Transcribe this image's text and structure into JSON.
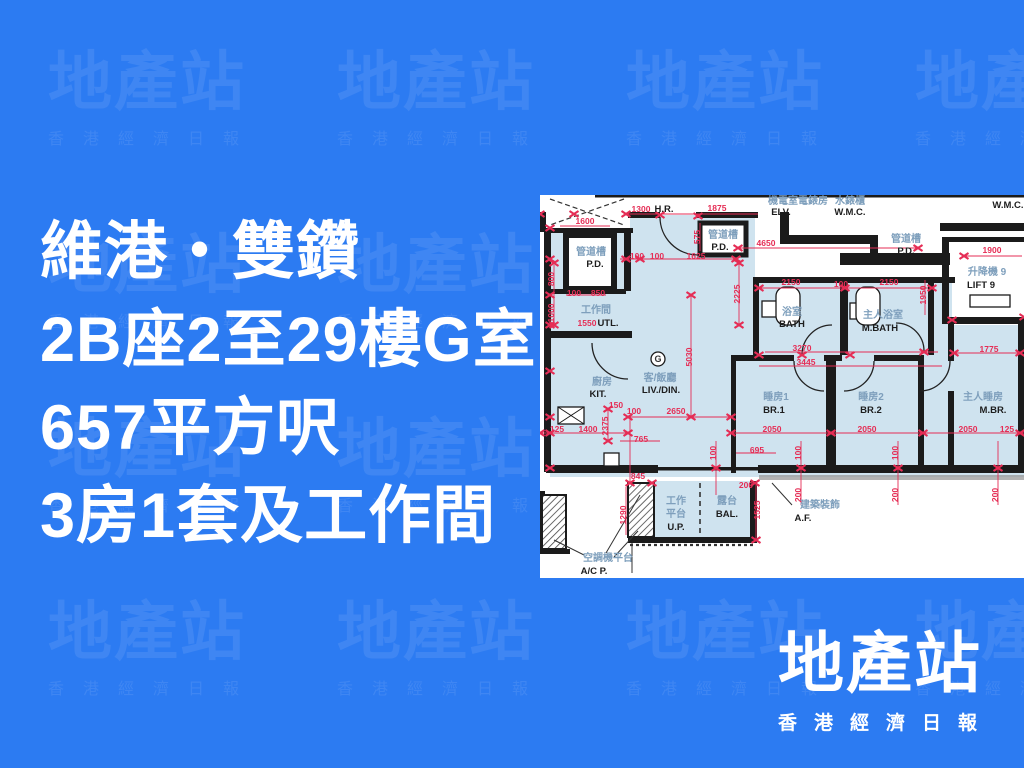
{
  "colors": {
    "background": "#2C7BF2",
    "watermark": "rgba(255,255,255,0.09)",
    "headline_text": "#FFFFFF",
    "plan_room_fill": "#CFE3EF",
    "plan_wall": "#1B1B1B",
    "plan_dimension": "#E52D55",
    "plan_label_chinese": "#7E9FBC",
    "plan_label_english": "#1D1D1D"
  },
  "watermark": {
    "title": "地產站",
    "subtitle": "香港經濟日報"
  },
  "headline": {
    "line1": "維港・雙鑽",
    "line2": "2B座2至29樓G室",
    "line3": "657平方呎",
    "line4": "3房1套及工作間"
  },
  "logo": {
    "title": "地產站",
    "subtitle": "香港經濟日報"
  },
  "floorplan": {
    "labels": [
      {
        "t": "H.R.",
        "x": 124,
        "y": 17,
        "c": "en"
      },
      {
        "t": "機電室電錶房",
        "x": 258,
        "y": 9,
        "c": "zh"
      },
      {
        "t": "ELV.",
        "x": 241,
        "y": 20,
        "c": "en"
      },
      {
        "t": "水錶櫃",
        "x": 310,
        "y": 9,
        "c": "zh"
      },
      {
        "t": "W.M.C.",
        "x": 310,
        "y": 20,
        "c": "en"
      },
      {
        "t": "W.M.C.",
        "x": 468,
        "y": 13,
        "c": "en"
      },
      {
        "t": "管道槽",
        "x": 51,
        "y": 60,
        "c": "zh"
      },
      {
        "t": "P.D.",
        "x": 55,
        "y": 72,
        "c": "en"
      },
      {
        "t": "管道槽",
        "x": 183,
        "y": 43,
        "c": "zh"
      },
      {
        "t": "P.D.",
        "x": 180,
        "y": 55,
        "c": "en"
      },
      {
        "t": "管道槽",
        "x": 366,
        "y": 47,
        "c": "zh"
      },
      {
        "t": "P.D.",
        "x": 366,
        "y": 59,
        "c": "en"
      },
      {
        "t": "升降機 9",
        "x": 447,
        "y": 80,
        "c": "zh"
      },
      {
        "t": "LIFT 9",
        "x": 441,
        "y": 93,
        "c": "en"
      },
      {
        "t": "工作間",
        "x": 56,
        "y": 118,
        "c": "zh"
      },
      {
        "t": "UTL.",
        "x": 68,
        "y": 131,
        "c": "en"
      },
      {
        "t": "廚房",
        "x": 62,
        "y": 190,
        "c": "zh"
      },
      {
        "t": "KIT.",
        "x": 58,
        "y": 202,
        "c": "en"
      },
      {
        "t": "G",
        "x": 118,
        "y": 167,
        "c": "g"
      },
      {
        "t": "客/飯廳",
        "x": 120,
        "y": 186,
        "c": "zh"
      },
      {
        "t": "LIV./DIN.",
        "x": 121,
        "y": 198,
        "c": "en"
      },
      {
        "t": "浴室",
        "x": 252,
        "y": 120,
        "c": "zh"
      },
      {
        "t": "BATH",
        "x": 252,
        "y": 132,
        "c": "en"
      },
      {
        "t": "主人浴室",
        "x": 343,
        "y": 123,
        "c": "zh"
      },
      {
        "t": "M.BATH",
        "x": 340,
        "y": 136,
        "c": "en"
      },
      {
        "t": "睡房1",
        "x": 236,
        "y": 205,
        "c": "zh"
      },
      {
        "t": "BR.1",
        "x": 234,
        "y": 218,
        "c": "en"
      },
      {
        "t": "睡房2",
        "x": 331,
        "y": 205,
        "c": "zh"
      },
      {
        "t": "BR.2",
        "x": 331,
        "y": 218,
        "c": "en"
      },
      {
        "t": "主人睡房",
        "x": 443,
        "y": 205,
        "c": "zh"
      },
      {
        "t": "M.BR.",
        "x": 453,
        "y": 218,
        "c": "en"
      },
      {
        "t": "工作",
        "x": 136,
        "y": 309,
        "c": "zh"
      },
      {
        "t": "平台",
        "x": 136,
        "y": 322,
        "c": "zh"
      },
      {
        "t": "U.P.",
        "x": 136,
        "y": 335,
        "c": "en"
      },
      {
        "t": "露台",
        "x": 187,
        "y": 309,
        "c": "zh"
      },
      {
        "t": "BAL.",
        "x": 187,
        "y": 322,
        "c": "en"
      },
      {
        "t": "建築裝飾",
        "x": 280,
        "y": 313,
        "c": "zh"
      },
      {
        "t": "A.F.",
        "x": 263,
        "y": 326,
        "c": "en"
      },
      {
        "t": "空調機平台",
        "x": 68,
        "y": 366,
        "c": "zh"
      },
      {
        "t": "A/C P.",
        "x": 54,
        "y": 379,
        "c": "en"
      }
    ],
    "dims": [
      {
        "t": "1300",
        "x": 101,
        "y": 17
      },
      {
        "t": "1875",
        "x": 177,
        "y": 16
      },
      {
        "t": "1600",
        "x": 45,
        "y": 29
      },
      {
        "t": "575",
        "x": 160,
        "y": 42,
        "v": 1
      },
      {
        "t": "100",
        "x": 34,
        "y": 101
      },
      {
        "t": "850",
        "x": 58,
        "y": 101
      },
      {
        "t": "800",
        "x": 14,
        "y": 84,
        "v": 1
      },
      {
        "t": "1000",
        "x": 14,
        "y": 118,
        "v": 1
      },
      {
        "t": "1550",
        "x": 47,
        "y": 131
      },
      {
        "t": "100",
        "x": 97,
        "y": 64
      },
      {
        "t": "100",
        "x": 117,
        "y": 64
      },
      {
        "t": "1625",
        "x": 156,
        "y": 64
      },
      {
        "t": "4650",
        "x": 226,
        "y": 51
      },
      {
        "t": "1900",
        "x": 452,
        "y": 58
      },
      {
        "t": "2150",
        "x": 251,
        "y": 90
      },
      {
        "t": "100",
        "x": 301,
        "y": 92
      },
      {
        "t": "2150",
        "x": 349,
        "y": 90
      },
      {
        "t": "2225",
        "x": 200,
        "y": 99,
        "v": 1
      },
      {
        "t": "1950",
        "x": 386,
        "y": 100,
        "v": 1
      },
      {
        "t": "5030",
        "x": 152,
        "y": 162,
        "v": 1
      },
      {
        "t": "3270",
        "x": 262,
        "y": 156
      },
      {
        "t": "3445",
        "x": 266,
        "y": 170
      },
      {
        "t": "1775",
        "x": 449,
        "y": 157
      },
      {
        "t": "150",
        "x": 76,
        "y": 213
      },
      {
        "t": "100",
        "x": 94,
        "y": 219
      },
      {
        "t": "2650",
        "x": 136,
        "y": 219
      },
      {
        "t": "2375",
        "x": 68,
        "y": 231,
        "v": 1
      },
      {
        "t": "125",
        "x": 17,
        "y": 237
      },
      {
        "t": "1400",
        "x": 48,
        "y": 237
      },
      {
        "t": "765",
        "x": 101,
        "y": 247
      },
      {
        "t": "695",
        "x": 217,
        "y": 258
      },
      {
        "t": "2050",
        "x": 232,
        "y": 237
      },
      {
        "t": "2050",
        "x": 327,
        "y": 237
      },
      {
        "t": "2050",
        "x": 428,
        "y": 237
      },
      {
        "t": "125",
        "x": 467,
        "y": 237
      },
      {
        "t": "845",
        "x": 98,
        "y": 284
      },
      {
        "t": "200",
        "x": 206,
        "y": 293
      },
      {
        "t": "100",
        "x": 176,
        "y": 258,
        "v": 1
      },
      {
        "t": "100",
        "x": 261,
        "y": 258,
        "v": 1
      },
      {
        "t": "100",
        "x": 358,
        "y": 258,
        "v": 1
      },
      {
        "t": "200",
        "x": 261,
        "y": 300,
        "v": 1
      },
      {
        "t": "200",
        "x": 358,
        "y": 300,
        "v": 1
      },
      {
        "t": "200",
        "x": 458,
        "y": 300,
        "v": 1
      },
      {
        "t": "1290",
        "x": 86,
        "y": 320,
        "v": 1
      },
      {
        "t": "1525",
        "x": 220,
        "y": 315,
        "v": 1
      }
    ],
    "markers": [
      [
        0,
        19
      ],
      [
        10,
        33
      ],
      [
        10,
        64
      ],
      [
        10,
        100
      ],
      [
        10,
        130
      ],
      [
        10,
        176
      ],
      [
        10,
        222
      ],
      [
        10,
        238
      ],
      [
        10,
        273
      ],
      [
        34,
        19
      ],
      [
        86,
        19
      ],
      [
        120,
        20
      ],
      [
        158,
        21
      ],
      [
        86,
        64
      ],
      [
        196,
        64
      ],
      [
        100,
        64
      ],
      [
        199,
        68
      ],
      [
        199,
        130
      ],
      [
        151,
        100
      ],
      [
        151,
        222
      ],
      [
        88,
        222
      ],
      [
        191,
        222
      ],
      [
        0,
        238
      ],
      [
        88,
        238
      ],
      [
        191,
        238
      ],
      [
        291,
        238
      ],
      [
        383,
        238
      ],
      [
        480,
        238
      ],
      [
        198,
        53
      ],
      [
        378,
        53
      ],
      [
        219,
        93
      ],
      [
        305,
        93
      ],
      [
        392,
        93
      ],
      [
        219,
        160
      ],
      [
        262,
        160
      ],
      [
        310,
        160
      ],
      [
        384,
        157
      ],
      [
        412,
        125
      ],
      [
        484,
        122
      ],
      [
        414,
        158
      ],
      [
        480,
        158
      ],
      [
        176,
        273
      ],
      [
        261,
        273
      ],
      [
        358,
        273
      ],
      [
        458,
        273
      ],
      [
        90,
        288
      ],
      [
        112,
        288
      ],
      [
        215,
        288
      ],
      [
        216,
        345
      ],
      [
        424,
        61
      ],
      [
        68,
        214
      ],
      [
        68,
        246
      ],
      [
        14,
        68
      ],
      [
        14,
        130
      ]
    ]
  }
}
